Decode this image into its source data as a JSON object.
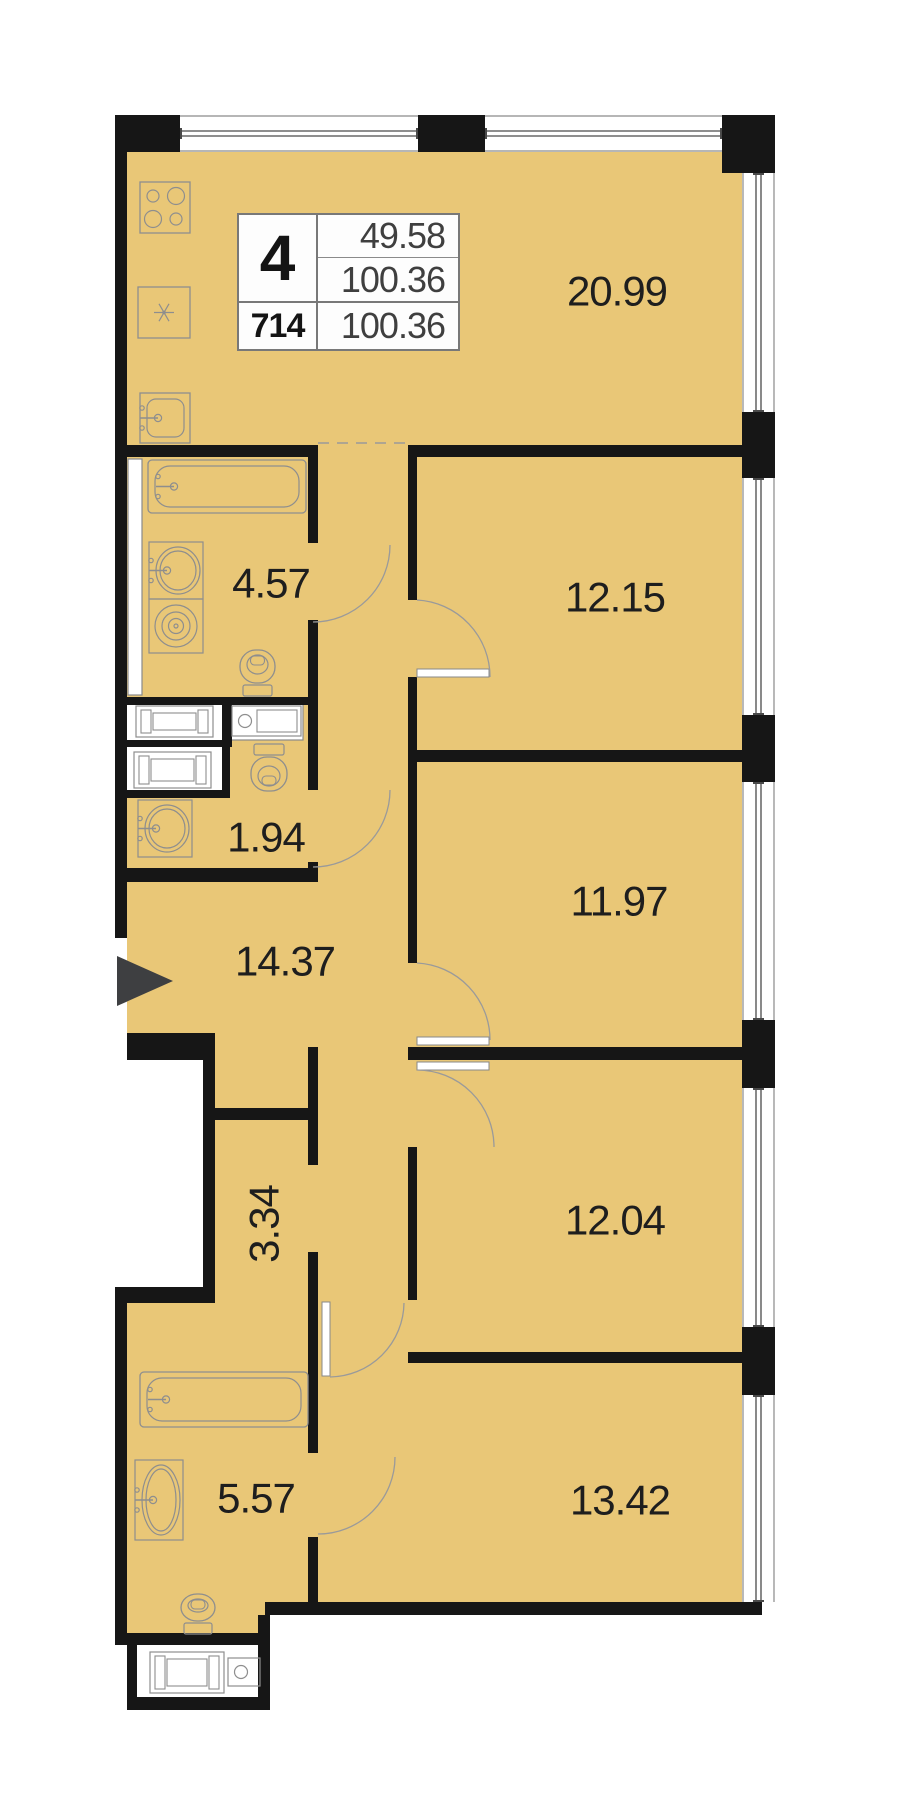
{
  "info_box": {
    "flat_number": "4",
    "area_living": "49.58",
    "area_total": "100.36",
    "flat_id": "714",
    "area_total_repeat": "100.36"
  },
  "colors": {
    "floor": "#e9c777",
    "wall": "#161616",
    "thin_line": "#8a8a8a",
    "glazing": "#4a4a4a",
    "fixture": "#8e8e8e",
    "arc": "#9a9a9a",
    "label_text": "#1e1e1e",
    "arrow": "#3e3f41",
    "white": "#ffffff"
  },
  "rooms": [
    {
      "id": "kitchen-living",
      "label": "20.99",
      "cx": 617,
      "cy": 291,
      "rot": 0
    },
    {
      "id": "bedroom-1",
      "label": "12.15",
      "cx": 615,
      "cy": 597,
      "rot": 0
    },
    {
      "id": "bathroom-1",
      "label": "4.57",
      "cx": 271,
      "cy": 583,
      "rot": 0
    },
    {
      "id": "wc",
      "label": "1.94",
      "cx": 266,
      "cy": 837,
      "rot": 0
    },
    {
      "id": "hallway",
      "label": "14.37",
      "cx": 285,
      "cy": 961,
      "rot": 0
    },
    {
      "id": "bedroom-2",
      "label": "11.97",
      "cx": 619,
      "cy": 901,
      "rot": 0
    },
    {
      "id": "corridor",
      "label": "3.34",
      "cx": 264,
      "cy": 1224,
      "rot": -90
    },
    {
      "id": "bedroom-3",
      "label": "12.04",
      "cx": 615,
      "cy": 1220,
      "rot": 0
    },
    {
      "id": "bathroom-2",
      "label": "5.57",
      "cx": 256,
      "cy": 1498,
      "rot": 0
    },
    {
      "id": "bedroom-4",
      "label": "13.42",
      "cx": 620,
      "cy": 1500,
      "rot": 0
    }
  ],
  "floor_rects": [
    [
      127,
      152,
      615,
      895
    ],
    [
      215,
      1047,
      527,
      305
    ],
    [
      127,
      1303,
      191,
      312
    ],
    [
      127,
      1615,
      143,
      18
    ],
    [
      318,
      1352,
      424,
      251
    ]
  ],
  "walls": [
    [
      115,
      115,
      12,
      823
    ],
    [
      127,
      115,
      53,
      37
    ],
    [
      418,
      115,
      67,
      37
    ],
    [
      722,
      115,
      53,
      58
    ],
    [
      742,
      412,
      33,
      66
    ],
    [
      742,
      715,
      33,
      67
    ],
    [
      742,
      1020,
      33,
      68
    ],
    [
      742,
      1327,
      33,
      68
    ],
    [
      742,
      1602,
      20,
      13
    ],
    [
      127,
      1033,
      88,
      27
    ],
    [
      203,
      1060,
      12,
      243
    ],
    [
      115,
      1287,
      100,
      16
    ],
    [
      115,
      1303,
      12,
      342
    ],
    [
      127,
      1633,
      143,
      12
    ],
    [
      127,
      1645,
      10,
      58
    ],
    [
      127,
      1697,
      143,
      13
    ],
    [
      258,
      1615,
      12,
      95
    ],
    [
      265,
      1602,
      497,
      13
    ],
    [
      115,
      445,
      203,
      12
    ],
    [
      408,
      445,
      334,
      12
    ],
    [
      408,
      750,
      334,
      12
    ],
    [
      408,
      1047,
      334,
      13
    ],
    [
      408,
      1352,
      334,
      11
    ],
    [
      115,
      697,
      203,
      8
    ],
    [
      115,
      740,
      115,
      7
    ],
    [
      115,
      868,
      203,
      14
    ],
    [
      308,
      457,
      10,
      86
    ],
    [
      308,
      620,
      10,
      170
    ],
    [
      308,
      862,
      10,
      20
    ],
    [
      308,
      1047,
      10,
      118
    ],
    [
      308,
      1252,
      10,
      201
    ],
    [
      308,
      1537,
      10,
      78
    ],
    [
      408,
      457,
      9,
      143
    ],
    [
      408,
      677,
      9,
      73
    ],
    [
      408,
      762,
      9,
      201
    ],
    [
      408,
      1147,
      9,
      153
    ],
    [
      215,
      1108,
      103,
      12
    ],
    [
      222,
      700,
      10,
      47
    ],
    [
      222,
      747,
      8,
      50
    ],
    [
      127,
      790,
      103,
      8
    ]
  ],
  "white_boxes": [
    {
      "name": "duct-shaft",
      "x": 128,
      "y": 459,
      "w": 14,
      "h": 236,
      "stroke": true
    },
    {
      "name": "washer-niche-1",
      "x": 127,
      "y": 702,
      "w": 95,
      "h": 38,
      "stroke": false
    },
    {
      "name": "washer-niche-2",
      "x": 230,
      "y": 702,
      "w": 73,
      "h": 38,
      "stroke": true
    },
    {
      "name": "washer-niche-3",
      "x": 127,
      "y": 747,
      "w": 95,
      "h": 43,
      "stroke": false
    },
    {
      "name": "utility-closet",
      "x": 137,
      "y": 1645,
      "w": 121,
      "h": 52,
      "stroke": false
    }
  ],
  "windows_top": [
    {
      "x": 180,
      "w": 238
    },
    {
      "x": 485,
      "w": 237
    }
  ],
  "windows_top_band": {
    "y": 115,
    "h": 37
  },
  "windows_right": [
    {
      "y": 173,
      "h": 239
    },
    {
      "y": 478,
      "h": 237
    },
    {
      "y": 782,
      "h": 238
    },
    {
      "y": 1088,
      "h": 239
    },
    {
      "y": 1395,
      "h": 207
    }
  ],
  "windows_right_band": {
    "x": 742,
    "w": 33
  },
  "dashed_lines": [
    {
      "x1": 318,
      "y1": 443,
      "x2": 408,
      "y2": 443
    }
  ],
  "door_arcs": [
    "M390 545 A77 77 0 0 1 313 622",
    "M390 790 A77 77 0 0 1 313 867",
    "M417 600 A77 77 0 0 1 490 677",
    "M417 963 A77 77 0 0 1 490 1040",
    "M417 1070 A77 77 0 0 1 494 1147",
    "M330 1377 A75 75 0 0 0 404 1303",
    "M395 1457 A77 77 0 0 1 318 1534"
  ],
  "door_leaves": [
    [
      417,
      669,
      72,
      8
    ],
    [
      417,
      1037,
      72,
      8
    ],
    [
      417,
      1062,
      72,
      8
    ],
    [
      322,
      1302,
      8,
      74
    ]
  ],
  "fixtures": [
    {
      "type": "stove",
      "name": "stove-icon",
      "x": 140,
      "y": 182,
      "w": 50,
      "h": 51
    },
    {
      "type": "fridge",
      "name": "fridge-icon",
      "x": 138,
      "y": 287,
      "w": 52,
      "h": 51
    },
    {
      "type": "ksink",
      "name": "kitchen-sink-icon",
      "x": 140,
      "y": 393,
      "w": 50,
      "h": 50
    },
    {
      "type": "tub",
      "name": "bathtub-icon",
      "x": 148,
      "y": 460,
      "w": 158,
      "h": 53
    },
    {
      "type": "ovalsink",
      "name": "sink-icon",
      "x": 149,
      "y": 542,
      "w": 54,
      "h": 57
    },
    {
      "type": "spiral",
      "name": "washer-drum-icon",
      "x": 149,
      "y": 599,
      "w": 54,
      "h": 54
    },
    {
      "type": "toilet",
      "name": "toilet-icon",
      "x": 240,
      "y": 650,
      "w": 35,
      "h": 46,
      "dir": "up"
    },
    {
      "type": "washer",
      "name": "washing-machine-icon",
      "x": 136,
      "y": 706,
      "w": 77,
      "h": 31
    },
    {
      "type": "circounter",
      "name": "dryer-counter-icon",
      "x": 232,
      "y": 706,
      "w": 69,
      "h": 30
    },
    {
      "type": "washer",
      "name": "washing-machine-icon",
      "x": 134,
      "y": 752,
      "w": 77,
      "h": 36
    },
    {
      "type": "toilet",
      "name": "toilet-icon",
      "x": 251,
      "y": 744,
      "w": 36,
      "h": 47,
      "dir": "down"
    },
    {
      "type": "ovalsink",
      "name": "sink-icon",
      "x": 138,
      "y": 800,
      "w": 54,
      "h": 57
    },
    {
      "type": "tub",
      "name": "bathtub-icon",
      "x": 140,
      "y": 1372,
      "w": 168,
      "h": 55
    },
    {
      "type": "ovalsink",
      "name": "sink-icon",
      "x": 135,
      "y": 1460,
      "w": 48,
      "h": 80
    },
    {
      "type": "toilet",
      "name": "toilet-icon",
      "x": 181,
      "y": 1594,
      "w": 34,
      "h": 40,
      "dir": "up"
    },
    {
      "type": "washer",
      "name": "washing-machine-icon",
      "x": 150,
      "y": 1652,
      "w": 74,
      "h": 41
    },
    {
      "type": "circounter",
      "name": "dryer-counter-icon",
      "x": 228,
      "y": 1658,
      "w": 32,
      "h": 28
    }
  ],
  "entrance_arrow": {
    "points": "117,956 117,1006 173,981"
  }
}
